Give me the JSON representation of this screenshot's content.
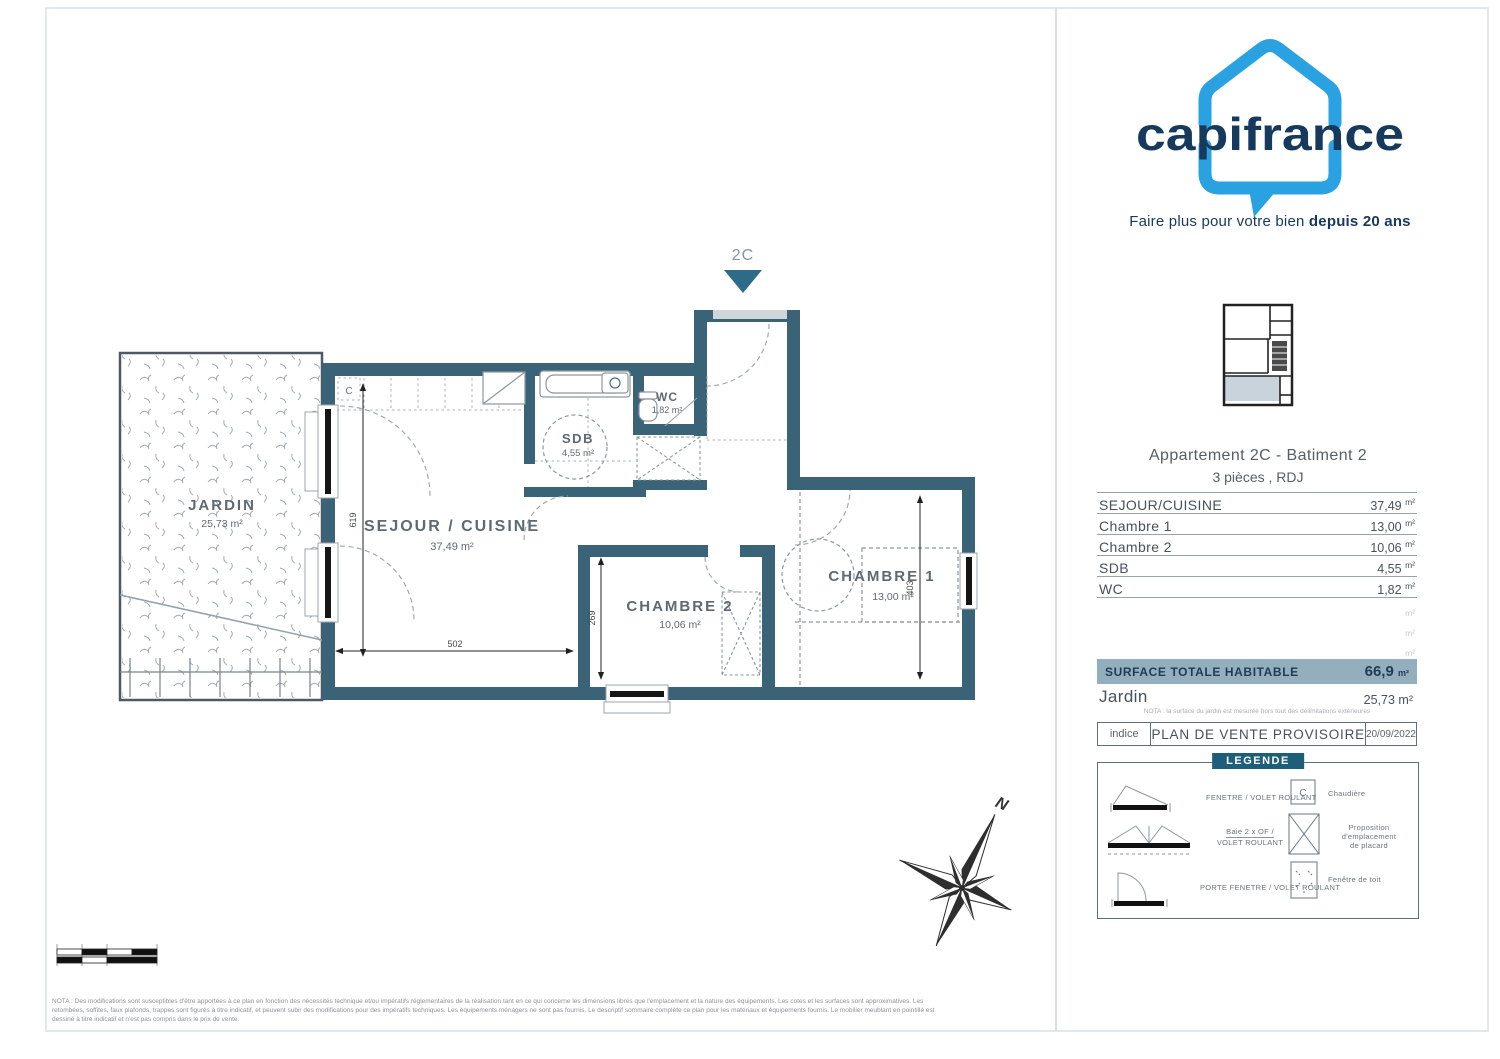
{
  "brand": {
    "name": "capifrance",
    "tagline": "Faire plus pour votre bien",
    "tagline_bold": "depuis 20 ans",
    "blue": "#2aa2e2",
    "navy": "#16395e"
  },
  "plan": {
    "entrance_label": "2C",
    "compass_north": "N",
    "chaudiere": "C",
    "wall_color": "#3b6377",
    "rooms": {
      "jardin": {
        "name": "JARDIN",
        "area": "25,73 m²"
      },
      "sejour": {
        "name": "SEJOUR / CUISINE",
        "area": "37,49 m²"
      },
      "sdb": {
        "name": "SDB",
        "area": "4,55 m²"
      },
      "wc": {
        "name": "WC",
        "area": "1,82 m²"
      },
      "chambre2": {
        "name": "CHAMBRE 2",
        "area": "10,06 m²"
      },
      "chambre1": {
        "name": "CHAMBRE 1",
        "area": "13,00 m²"
      }
    },
    "dimensions": {
      "sejour_height": "619",
      "sejour_width": "502",
      "chambre2_height": "269",
      "chambre1_height": "403"
    }
  },
  "panel": {
    "title": "Appartement 2C - Batiment 2",
    "subtitle": "3 pièces , RDJ",
    "surface_table": {
      "rows": [
        {
          "label": "SEJOUR/CUISINE",
          "value": "37,49",
          "unit": "m²"
        },
        {
          "label": "Chambre 1",
          "value": "13,00",
          "unit": "m²"
        },
        {
          "label": "Chambre 2",
          "value": "10,06",
          "unit": "m²"
        },
        {
          "label": "SDB",
          "value": "4,55",
          "unit": "m²"
        },
        {
          "label": "WC",
          "value": "1,82",
          "unit": "m²"
        }
      ],
      "empty_unit": "m²"
    },
    "total": {
      "label": "SURFACE TOTALE HABITABLE",
      "value": "66,9",
      "unit": "m²"
    },
    "jardin_row": {
      "label": "Jardin",
      "value": "25,73",
      "unit": "m²"
    },
    "jardin_note": "NOTA : la surface du jardin est mesurée hors tout des délimitations extérieures",
    "revision": {
      "indice_label": "indice",
      "title": "PLAN DE VENTE PROVISOIRE",
      "date": "20/09/2022"
    },
    "legend": {
      "title": "LEGENDE",
      "left": [
        {
          "label": "FENETRE / VOLET ROULANT"
        },
        {
          "label_top": "Baie 2 x OF /",
          "label_bottom": "VOLET ROULANT"
        },
        {
          "label": "PORTE FENETRE / VOLET ROULANT"
        }
      ],
      "right": [
        {
          "symbol": "C",
          "label": "Chaudière"
        },
        {
          "label_top": "Proposition d'emplacement",
          "label_bottom": "de placard"
        },
        {
          "label": "Fenêtre de toit"
        }
      ]
    }
  },
  "footer_note": "NOTA : Des modifications sont susceptibles d'être apportées à ce plan en fonction des nécessités technique et/ou impératifs réglementaires de la réalisation tant en ce qui concerne les dimensions libres que l'emplacement et la nature des équipements. Les cotes et les surfaces sont approximatives. Les retombées, soffites, faux plafonds, trappes sont figurés à titre indicatif, et peuvent subir des modifications pour des impératifs techniques. Les équipements ménagers ne sont pas fournis. Le descriptif sommaire complète ce plan pour les matériaux et équipements fournis. Le mobilier meublant en pointillé est dessiné à titre indicatif et n'est pas compris dans le prix de vente."
}
